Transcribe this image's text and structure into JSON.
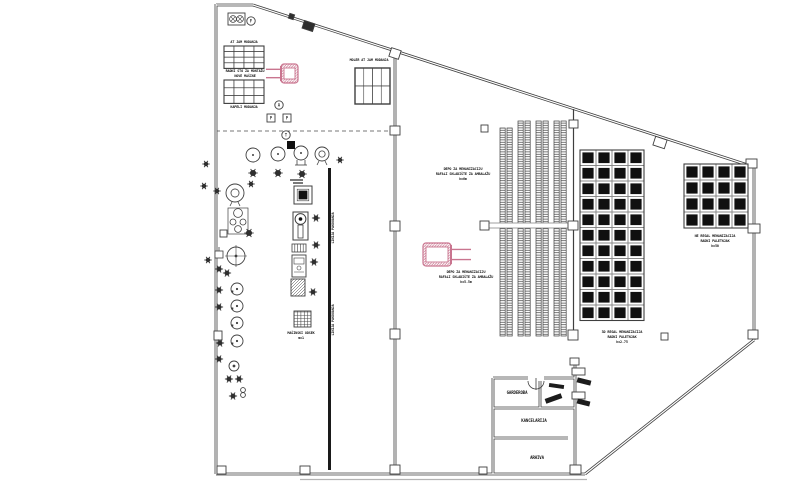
{
  "drawing": {
    "title_note": "warehouse-floor-plan",
    "colors": {
      "bg": "#ffffff",
      "ink": "#3f3f3f",
      "dark": "#101010",
      "gray": "#8a8a8a",
      "pink": "#c9758f",
      "ground": "#b3b3b3"
    },
    "walls_double": [
      [
        216,
        4,
        216,
        474
      ],
      [
        216,
        5,
        253,
        5
      ],
      [
        253,
        5,
        754,
        167
      ],
      [
        754,
        167,
        754,
        340
      ],
      [
        754,
        340,
        585,
        474
      ],
      [
        585,
        474,
        216,
        474
      ],
      [
        395,
        51,
        395,
        471
      ],
      [
        493,
        378,
        528,
        378
      ],
      [
        544,
        378,
        575,
        378
      ],
      [
        493,
        378,
        493,
        474
      ],
      [
        575,
        360,
        575,
        474
      ],
      [
        493,
        408,
        575,
        408
      ],
      [
        493,
        438,
        568,
        438
      ],
      [
        540,
        381,
        540,
        408
      ]
    ],
    "walls_single": [
      [
        573.5,
        109,
        573.5,
        336
      ]
    ],
    "dashed": [
      [
        216,
        131,
        395,
        131
      ]
    ],
    "ground_line": [
      300,
      479.5,
      587,
      479.5
    ],
    "conveyor": {
      "x": 329.5,
      "y1": 168,
      "y2": 470,
      "w": 3
    },
    "beam": {
      "x": 483,
      "y": 223,
      "w": 92,
      "h": 5
    },
    "racks": {
      "strip_w": 5.2,
      "gap": 1.8,
      "items": [
        {
          "x": 500,
          "y": 128,
          "h": 208
        },
        {
          "x": 518,
          "y": 121,
          "h": 215
        },
        {
          "x": 536,
          "y": 121,
          "h": 215
        },
        {
          "x": 554,
          "y": 121,
          "h": 215
        }
      ]
    },
    "grids": [
      {
        "name": "pallet-top-a",
        "x": 224,
        "y": 46,
        "cols": 4,
        "rows": 4,
        "cw": 10,
        "ch": 5.6,
        "style": "open"
      },
      {
        "name": "pallet-top-b",
        "x": 224,
        "y": 80,
        "cols": 4,
        "rows": 3,
        "cw": 10,
        "ch": 7.8,
        "style": "open"
      },
      {
        "name": "window",
        "x": 355,
        "y": 68,
        "cols": 2,
        "rows": 2,
        "cw": 17.5,
        "ch": 18,
        "style": "window"
      },
      {
        "name": "block-storage-center",
        "x": 580,
        "y": 150,
        "cols": 4,
        "rows": 11,
        "cw": 16,
        "ch": 15.5,
        "style": "dark"
      },
      {
        "name": "block-storage-right",
        "x": 684,
        "y": 164,
        "cols": 4,
        "rows": 4,
        "cw": 16,
        "ch": 16,
        "style": "dark"
      }
    ],
    "columns": [
      {
        "x": 289,
        "y": 14,
        "w": 5,
        "h": 5,
        "rot": 18,
        "fill": "dark"
      },
      {
        "x": 303,
        "y": 22,
        "w": 11,
        "h": 8,
        "rot": 18,
        "fill": "dark"
      },
      {
        "x": 390,
        "y": 49,
        "w": 10,
        "h": 9,
        "rot": 18
      },
      {
        "x": 654,
        "y": 138,
        "w": 12,
        "h": 9,
        "rot": 18
      },
      {
        "x": 746,
        "y": 159,
        "w": 11,
        "h": 9
      },
      {
        "x": 390,
        "y": 126,
        "w": 10,
        "h": 9
      },
      {
        "x": 390,
        "y": 221,
        "w": 10,
        "h": 10
      },
      {
        "x": 390,
        "y": 329,
        "w": 10,
        "h": 10
      },
      {
        "x": 390,
        "y": 465,
        "w": 10,
        "h": 9
      },
      {
        "x": 569,
        "y": 120,
        "w": 9,
        "h": 8
      },
      {
        "x": 568,
        "y": 221,
        "w": 10,
        "h": 9
      },
      {
        "x": 568,
        "y": 330,
        "w": 10,
        "h": 10
      },
      {
        "x": 480,
        "y": 221,
        "w": 9,
        "h": 9
      },
      {
        "x": 481,
        "y": 125,
        "w": 7,
        "h": 7
      },
      {
        "x": 748,
        "y": 224,
        "w": 12,
        "h": 9
      },
      {
        "x": 748,
        "y": 330,
        "w": 10,
        "h": 9
      },
      {
        "x": 661,
        "y": 333,
        "w": 7,
        "h": 7
      },
      {
        "x": 217,
        "y": 466,
        "w": 9,
        "h": 8
      },
      {
        "x": 300,
        "y": 466,
        "w": 10,
        "h": 8
      },
      {
        "x": 479,
        "y": 467,
        "w": 8,
        "h": 7
      },
      {
        "x": 570,
        "y": 465,
        "w": 11,
        "h": 9
      },
      {
        "x": 570,
        "y": 358,
        "w": 9,
        "h": 7
      },
      {
        "x": 572,
        "y": 368,
        "w": 13,
        "h": 7
      },
      {
        "x": 572,
        "y": 392,
        "w": 13,
        "h": 7
      }
    ],
    "machines": [
      {
        "t": "fanbox",
        "x": 228,
        "y": 13,
        "w": 17,
        "h": 12
      },
      {
        "t": "circletter",
        "x": 251,
        "y": 21,
        "r": 4.2,
        "ch": "F"
      },
      {
        "t": "circle",
        "x": 253,
        "y": 155,
        "r": 7
      },
      {
        "t": "circle",
        "x": 278,
        "y": 154,
        "r": 7
      },
      {
        "t": "trolley",
        "x": 301,
        "y": 153,
        "r": 7
      },
      {
        "t": "double",
        "x": 322,
        "y": 154,
        "r": 7
      },
      {
        "t": "gear",
        "x": 340,
        "y": 160,
        "r": 2.6
      },
      {
        "t": "gear",
        "x": 253,
        "y": 173,
        "r": 3.6
      },
      {
        "t": "gear",
        "x": 278,
        "y": 173,
        "r": 3.6
      },
      {
        "t": "gear",
        "x": 302,
        "y": 174,
        "r": 3.6
      },
      {
        "t": "bars",
        "x": 290,
        "y": 180,
        "w": 13
      },
      {
        "t": "gear",
        "x": 251,
        "y": 184,
        "r": 2.6
      },
      {
        "t": "double",
        "x": 235,
        "y": 193,
        "r": 9
      },
      {
        "t": "gear",
        "x": 217,
        "y": 191,
        "r": 2.6
      },
      {
        "t": "bigsquare",
        "x": 294,
        "y": 186,
        "w": 18,
        "h": 18
      },
      {
        "t": "machine2",
        "x": 293,
        "y": 212,
        "w": 15,
        "h": 28
      },
      {
        "t": "striped",
        "x": 292,
        "y": 244,
        "w": 14,
        "h": 8
      },
      {
        "t": "detail",
        "x": 292,
        "y": 255,
        "w": 14,
        "h": 22
      },
      {
        "t": "hatchrect",
        "x": 291,
        "y": 279,
        "w": 14,
        "h": 17
      },
      {
        "t": "gridhatch",
        "x": 294,
        "y": 311,
        "w": 17,
        "h": 16
      },
      {
        "t": "gear",
        "x": 316,
        "y": 218,
        "r": 3
      },
      {
        "t": "gear",
        "x": 316,
        "y": 245,
        "r": 3
      },
      {
        "t": "gear",
        "x": 314,
        "y": 262,
        "r": 3
      },
      {
        "t": "gear",
        "x": 313,
        "y": 292,
        "r": 3
      },
      {
        "t": "assembly",
        "x": 228,
        "y": 208,
        "w": 20,
        "h": 26
      },
      {
        "t": "square",
        "x": 220,
        "y": 230,
        "w": 7,
        "h": 7
      },
      {
        "t": "gear",
        "x": 249,
        "y": 233,
        "r": 3.6
      },
      {
        "t": "crosshair",
        "x": 236,
        "y": 256,
        "r": 9
      },
      {
        "t": "flag",
        "x": 215,
        "y": 251,
        "w": 8,
        "h": 7
      },
      {
        "t": "gear",
        "x": 219,
        "y": 269,
        "r": 3
      },
      {
        "t": "gear",
        "x": 227,
        "y": 273,
        "r": 3
      },
      {
        "t": "notch",
        "x": 237,
        "y": 289,
        "r": 6
      },
      {
        "t": "gear",
        "x": 219,
        "y": 290,
        "r": 3
      },
      {
        "t": "notch",
        "x": 237,
        "y": 306,
        "r": 6
      },
      {
        "t": "gear",
        "x": 219,
        "y": 307,
        "r": 3
      },
      {
        "t": "notch",
        "x": 237,
        "y": 323,
        "r": 6
      },
      {
        "t": "square",
        "x": 214,
        "y": 331,
        "w": 8,
        "h": 9
      },
      {
        "t": "notch",
        "x": 237,
        "y": 341,
        "r": 6
      },
      {
        "t": "gear",
        "x": 220,
        "y": 343,
        "r": 3
      },
      {
        "t": "gear",
        "x": 219,
        "y": 359,
        "r": 3
      },
      {
        "t": "dotcircle",
        "x": 234,
        "y": 366,
        "r": 5
      },
      {
        "t": "gear",
        "x": 229,
        "y": 379,
        "r": 3
      },
      {
        "t": "gear",
        "x": 239,
        "y": 379,
        "r": 3
      },
      {
        "t": "gear",
        "x": 233,
        "y": 396,
        "r": 3
      },
      {
        "t": "bshape",
        "x": 243,
        "y": 390
      },
      {
        "t": "gear",
        "x": 206,
        "y": 164,
        "r": 2.6
      },
      {
        "t": "gear",
        "x": 204,
        "y": 186,
        "r": 2.6
      },
      {
        "t": "gear",
        "x": 208,
        "y": 260,
        "r": 2.6
      },
      {
        "t": "circletter",
        "x": 279,
        "y": 105,
        "r": 4.2,
        "ch": "A"
      },
      {
        "t": "boxletter",
        "x": 267,
        "y": 114,
        "w": 8,
        "ch": "P"
      },
      {
        "t": "boxletter",
        "x": 283,
        "y": 114,
        "w": 8,
        "ch": "P"
      },
      {
        "t": "circletter",
        "x": 286,
        "y": 135,
        "r": 4.2,
        "ch": "T"
      },
      {
        "t": "darksquare",
        "x": 287,
        "y": 141,
        "w": 8,
        "h": 8
      }
    ],
    "forklifts": [
      {
        "x": 281,
        "y": 64,
        "w": 17,
        "h": 19,
        "forks": "left",
        "fl": 15
      },
      {
        "x": 423,
        "y": 243,
        "w": 28,
        "h": 23,
        "forks": "right",
        "fl": 20
      }
    ],
    "door": {
      "arc1": "M 528 381 A 8 8 0 0 0 536 389",
      "arc2": "M 544 381 A 8 8 0 0 1 536 389",
      "mid": [
        536,
        378,
        536,
        390
      ]
    },
    "door_leaves": [
      {
        "x": 545,
        "y": 396,
        "w": 17,
        "h": 5,
        "rot": -20
      },
      {
        "x": 549,
        "y": 384,
        "w": 15,
        "h": 4,
        "rot": 8
      },
      {
        "x": 577,
        "y": 379,
        "w": 14,
        "h": 5,
        "rot": 14
      },
      {
        "x": 577,
        "y": 400,
        "w": 13,
        "h": 5,
        "rot": 14
      }
    ],
    "labels": [
      {
        "x": 244,
        "y": 43,
        "t": "AT JAM MODANJA"
      },
      {
        "x": 245,
        "y": 72,
        "t": "RADNI STO ZA MONTAŽU"
      },
      {
        "x": 245,
        "y": 77,
        "t": "NOVE MAŠINE"
      },
      {
        "x": 244,
        "y": 108,
        "t": "KAPELI MODANJA"
      },
      {
        "x": 369,
        "y": 61,
        "t": "MOLER AT JAM MODANJA"
      },
      {
        "x": 301,
        "y": 334,
        "t": "MAŠINSKI ODSEK"
      },
      {
        "x": 301,
        "y": 339,
        "t": "m=1"
      },
      {
        "x": 334,
        "y": 228,
        "t": "LINIJA PAKOVANJA",
        "rot": -90
      },
      {
        "x": 334,
        "y": 320,
        "t": "LINIJA PAKOVANJA",
        "rot": -90
      },
      {
        "x": 463,
        "y": 170,
        "t": "DEPO ZA MEHANIZACIJU"
      },
      {
        "x": 463,
        "y": 175,
        "t": "RAFALI SKLADIŠTE ZA AMBALAŽU"
      },
      {
        "x": 463,
        "y": 180,
        "t": "h=6m"
      },
      {
        "x": 466,
        "y": 273,
        "t": "DEPO ZA MEHANIZACIJU"
      },
      {
        "x": 466,
        "y": 278,
        "t": "RAFALI SKLADIŠTE ZA AMBALAŽU"
      },
      {
        "x": 466,
        "y": 283,
        "t": "h=5.5m"
      },
      {
        "x": 622,
        "y": 333,
        "t": "3D REGAL MEHANIZACIJA"
      },
      {
        "x": 622,
        "y": 338,
        "t": "RADNI PALETNJAK"
      },
      {
        "x": 622,
        "y": 343,
        "t": "h=2.75"
      },
      {
        "x": 715,
        "y": 237,
        "t": "NE REGAL MEHANIZACIJA"
      },
      {
        "x": 715,
        "y": 242,
        "t": "RADNI PALETNJAK"
      },
      {
        "x": 715,
        "y": 247,
        "t": "h=50"
      },
      {
        "x": 517,
        "y": 394,
        "t": "GARDEROBA",
        "s": 4
      },
      {
        "x": 556,
        "y": 398,
        "t": "WC",
        "s": 3.2
      },
      {
        "x": 534,
        "y": 422,
        "t": "KANCELARIJA",
        "s": 4
      },
      {
        "x": 537,
        "y": 459,
        "t": "ARHIVA",
        "s": 4
      }
    ]
  }
}
